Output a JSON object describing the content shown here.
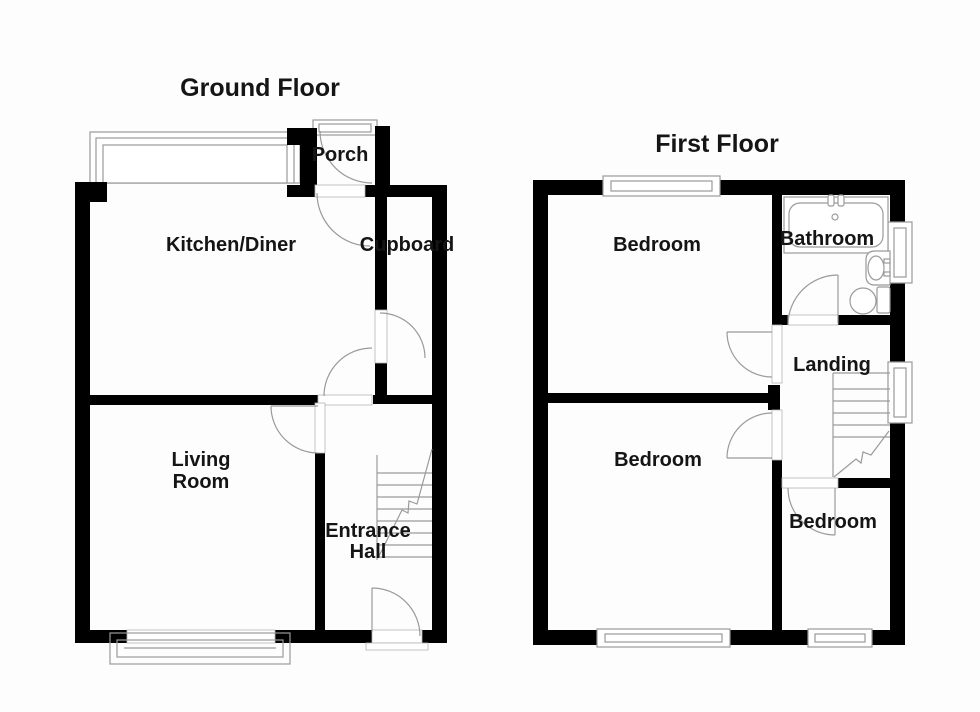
{
  "ground_floor": {
    "title": "Ground Floor",
    "labels": {
      "porch": "Porch",
      "kitchen_diner": "Kitchen/Diner",
      "cupboard": "Cupboard",
      "living_line1": "Living",
      "living_line2": "Room",
      "hall_line1": "Entrance",
      "hall_line2": "Hall"
    }
  },
  "first_floor": {
    "title": "First Floor",
    "labels": {
      "bedroom_front": "Bedroom",
      "bathroom": "Bathroom",
      "landing": "Landing",
      "bedroom_back": "Bedroom",
      "bedroom_side": "Bedroom"
    }
  },
  "colors": {
    "wall": "#000000",
    "thin_line": "#9a9a9a",
    "text": "#151515",
    "background": "#ffffff"
  }
}
